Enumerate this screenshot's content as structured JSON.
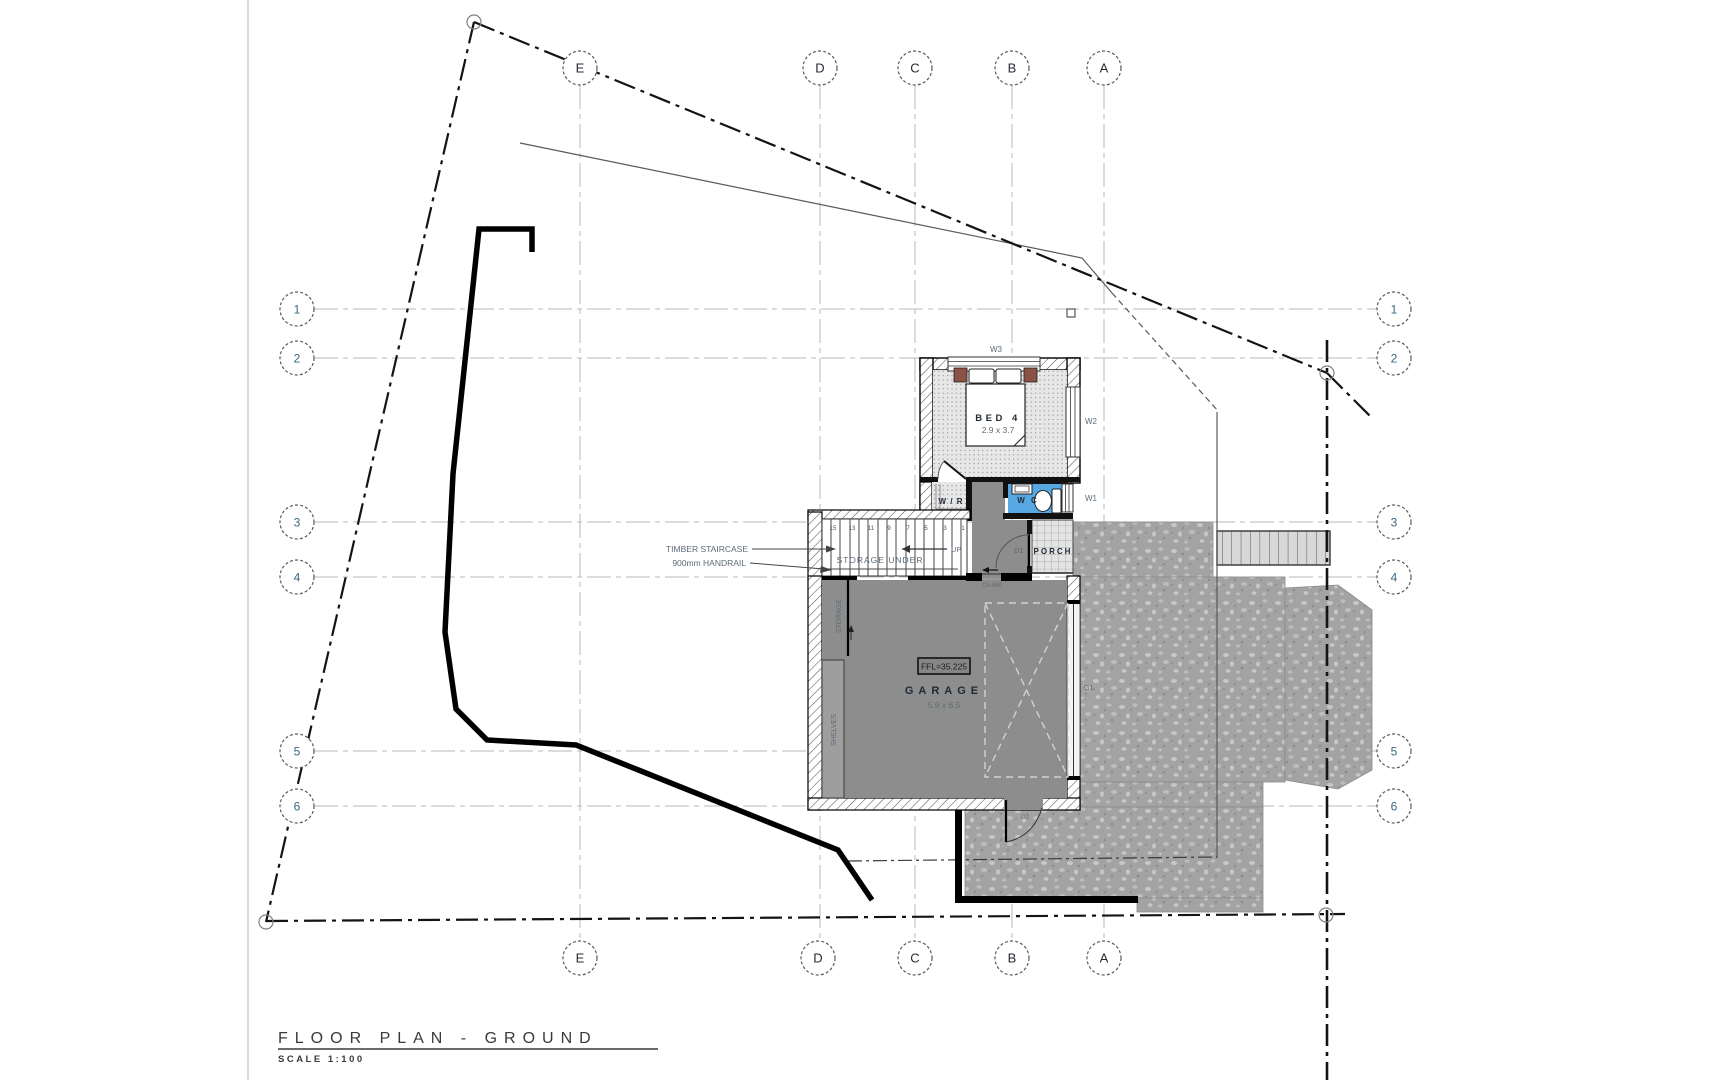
{
  "drawing": {
    "title": "FLOOR PLAN - GROUND",
    "scale_label": "SCALE 1:100"
  },
  "grid": {
    "columns": [
      {
        "label": "E"
      },
      {
        "label": "D"
      },
      {
        "label": "C"
      },
      {
        "label": "B"
      },
      {
        "label": "A"
      }
    ],
    "rows": [
      {
        "label": "1"
      },
      {
        "label": "2"
      },
      {
        "label": "3"
      },
      {
        "label": "4"
      },
      {
        "label": "5"
      },
      {
        "label": "6"
      }
    ]
  },
  "rooms": {
    "bed4": {
      "name": "BED 4",
      "dims": "2.9 x 3.7"
    },
    "wr": {
      "name": "W / R"
    },
    "wc": {
      "name": "W C"
    },
    "porch": {
      "name": "PORCH"
    },
    "garage": {
      "name": "GARAGE",
      "dims": "5.9 x 6.5",
      "ffl": "FFL=35.225"
    }
  },
  "openings": {
    "w1": "W1",
    "w2": "W2",
    "w3": "W3",
    "d1": "D1",
    "d2": "D2",
    "g1": "G1",
    "threshold": "CS-860"
  },
  "annotations": {
    "timber_staircase": "TIMBER STAIRCASE",
    "handrail": "900mm HANDRAIL",
    "storage_under": "STORAGE UNDER",
    "up": "UP",
    "storage": "STORAGE",
    "shelves": "SHELVES"
  },
  "stairs": {
    "tread_numbers": [
      "15",
      "13",
      "11",
      "9",
      "7",
      "5",
      "3",
      "1"
    ]
  },
  "colors": {
    "wc_floor_blue": "#57a7e3",
    "garage_floor_gray": "#8d8d8d",
    "bedside_table_brown": "#8a5144",
    "driveway_gray": "#a3a3a3",
    "boundary_black": "#141414",
    "grid_gray": "#b8b8b8"
  }
}
